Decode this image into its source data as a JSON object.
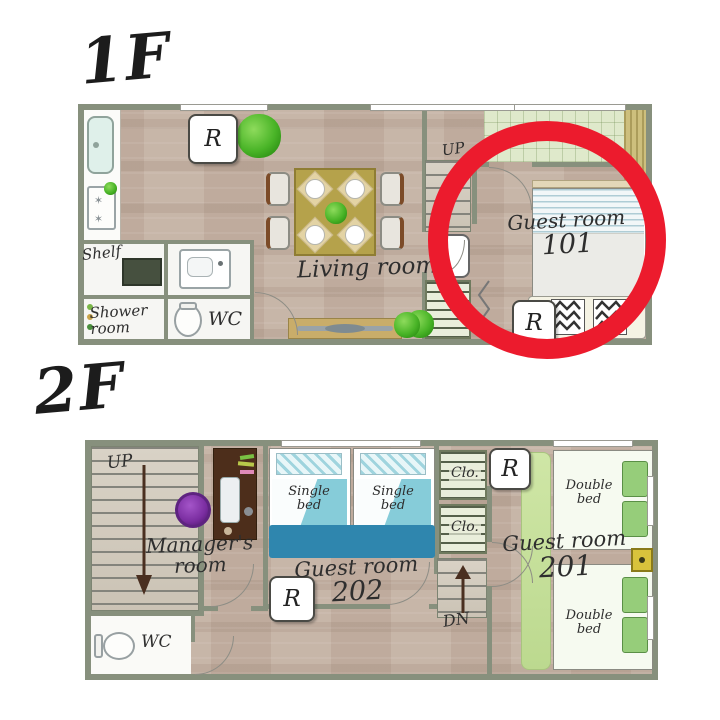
{
  "f1": {
    "title": "1F",
    "shelf": "Shelf",
    "shower_room": "Shower room",
    "wc": "WC",
    "living_room": "Living room",
    "up": "UP",
    "guest_room": "Guest room",
    "room_number": "101",
    "fridge": "R"
  },
  "f2": {
    "title": "2F",
    "up": "UP",
    "managers_room": "Manager's room",
    "wc": "WC",
    "single_bed": "Single bed",
    "guest_room_202": "Guest room",
    "room_number_202": "202",
    "closet": "Clo.",
    "dn": "DN",
    "guest_room_201": "Guest room",
    "room_number_201": "201",
    "double_bed": "Double bed",
    "fridge": "R"
  },
  "colors": {
    "highlight_ring": "#ec1b2d",
    "walls": "#87907d",
    "wood_floor": "#c4b1a3",
    "teal_bed": "#7ec9da",
    "blue_blanket": "#2f86ae",
    "green_bed": "#96cd7a",
    "entrance_tatami": "#dfe9cb"
  }
}
